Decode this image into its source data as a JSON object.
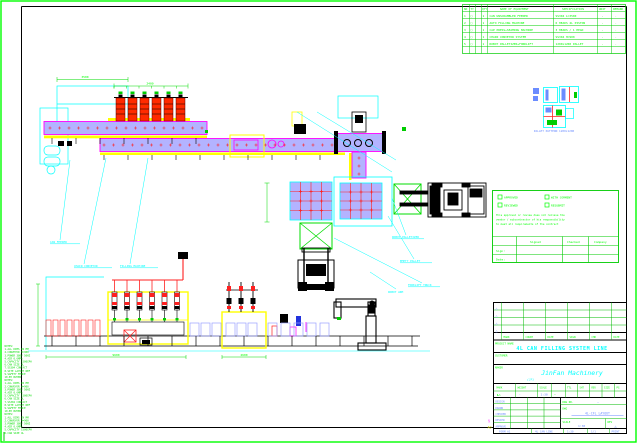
{
  "colors": {
    "green": "#00ff00",
    "grid_green": "#00cc00",
    "cyan": "#00ffff",
    "magenta": "#ff00ff",
    "red": "#ff2020",
    "yellow": "#ffff00",
    "blue_text": "#6b8cff",
    "band_fill": "#b3b3ff",
    "black": "#000000"
  },
  "parts_table": {
    "headers": [
      "NO",
      "TY",
      "QTY",
      "NAME OF EQUIPMENT",
      "SPECIFICATION",
      "UNIT",
      "REMARK"
    ],
    "rows": [
      [
        "1",
        "□",
        "1",
        "CAN UNSCRAMBLER FEEDER",
        "SS304 L=3500",
        "-",
        "."
      ],
      [
        "2",
        "□",
        "1",
        "AUTO FILLING MACHINE",
        "6 HEADS 4L PISTON",
        "-",
        "."
      ],
      [
        "3",
        "□",
        "1",
        "CAP PRESS+SEAMING MACHINE",
        "3 HEADS / 1 HEAD",
        "-",
        "."
      ],
      [
        "4",
        "□",
        "1",
        "CHAIN CONVEYOR SYSTEM",
        "SS304 H=900",
        "-",
        "."
      ],
      [
        "5",
        "□",
        "1",
        "ROBOT PALLETIZER+FORKLIFT",
        "1200x1200 PALLET",
        "-",
        "."
      ]
    ]
  },
  "detail_inset": {
    "label": "PALLET PATTERN 1200x1200"
  },
  "stamp": {
    "checkboxes": [
      "APPROVED",
      "WITH COMMENT",
      "REVIEWED",
      "RESUBMIT"
    ],
    "note_lines": [
      "This approval or review does not relieve the",
      "vendor / subcontractor of his responsibility",
      "to meet all requirements of the contract"
    ],
    "columns": [
      "Signed",
      "Checked",
      "Company"
    ],
    "row_labels": [
      "Sign:",
      "Date:"
    ]
  },
  "title_block": {
    "rev_headers": [
      "MARK",
      "COUNT",
      "DATE",
      "SIGN",
      "CHK",
      "DATE"
    ],
    "rev_marks": [
      "△",
      "△",
      "△",
      "△"
    ],
    "project_label": "PROJECT NAME",
    "title": "4L CAN FILLING SYSTEM LINE",
    "customer_label": "CUSTOMER",
    "maker_label": "MAKER",
    "company": "JinFan Machinery",
    "company_sub": "(JF)",
    "mid_labels": [
      "MARK",
      "WEIGHT",
      "SCALE"
    ],
    "mid_values": [
      "◣△",
      "·",
      "1:30"
    ],
    "mid_dash": "—",
    "right_headers": [
      "TTL",
      "SHT",
      "REV",
      "SIZE",
      "PG"
    ],
    "sign_rows": [
      "DESIGN",
      "DRAWN",
      "CHECKED",
      "REVIEW",
      "APPROVE"
    ],
    "dwg_no_label": "DWG NO.",
    "dwg_no_value": "—",
    "dwg_label": "DWG",
    "drawing_name": "4L-CFL LAYOUT",
    "scale_label": "SCALE",
    "scale_value": "1:30",
    "rev_label": "REV",
    "rev_value": "△",
    "bottom_strip": [
      "FORM A1",
      "4L CAN LINE",
      "1:30",
      "1/1",
      "PRINT"
    ]
  },
  "plan_callouts": [
    "CAN FEEDER",
    "CHAIN CONVEYOR",
    "FILLING MACHINE"
  ],
  "pallet_callouts": [
    "ROBOT PALLETIZER",
    "EMPTY PALLET",
    "FORKLIFT TRUCK"
  ],
  "elev_callout": "ROBOT ARM",
  "dims": {
    "top_left": "3500",
    "filler": "2400",
    "line_length": "9600",
    "capper": "2600"
  },
  "corner_marks": {
    "magenta": "§",
    "yellow": "A0"
  },
  "notes": [
    "NOTES:",
    "1.ALL DIMS IN MM",
    "2.CONVEYOR H=900",
    "3.POWER 380V 50HZ",
    "4.AIR 0.6MPA",
    "5.CAPACITY 1500CPH",
    "6.CAN SIZE 4L",
    "7.SS304 CONTACT",
    "8.SITE LAYOUT REF",
    "9.SAFETY FENCE",
    "10.BY BUYER"
  ]
}
